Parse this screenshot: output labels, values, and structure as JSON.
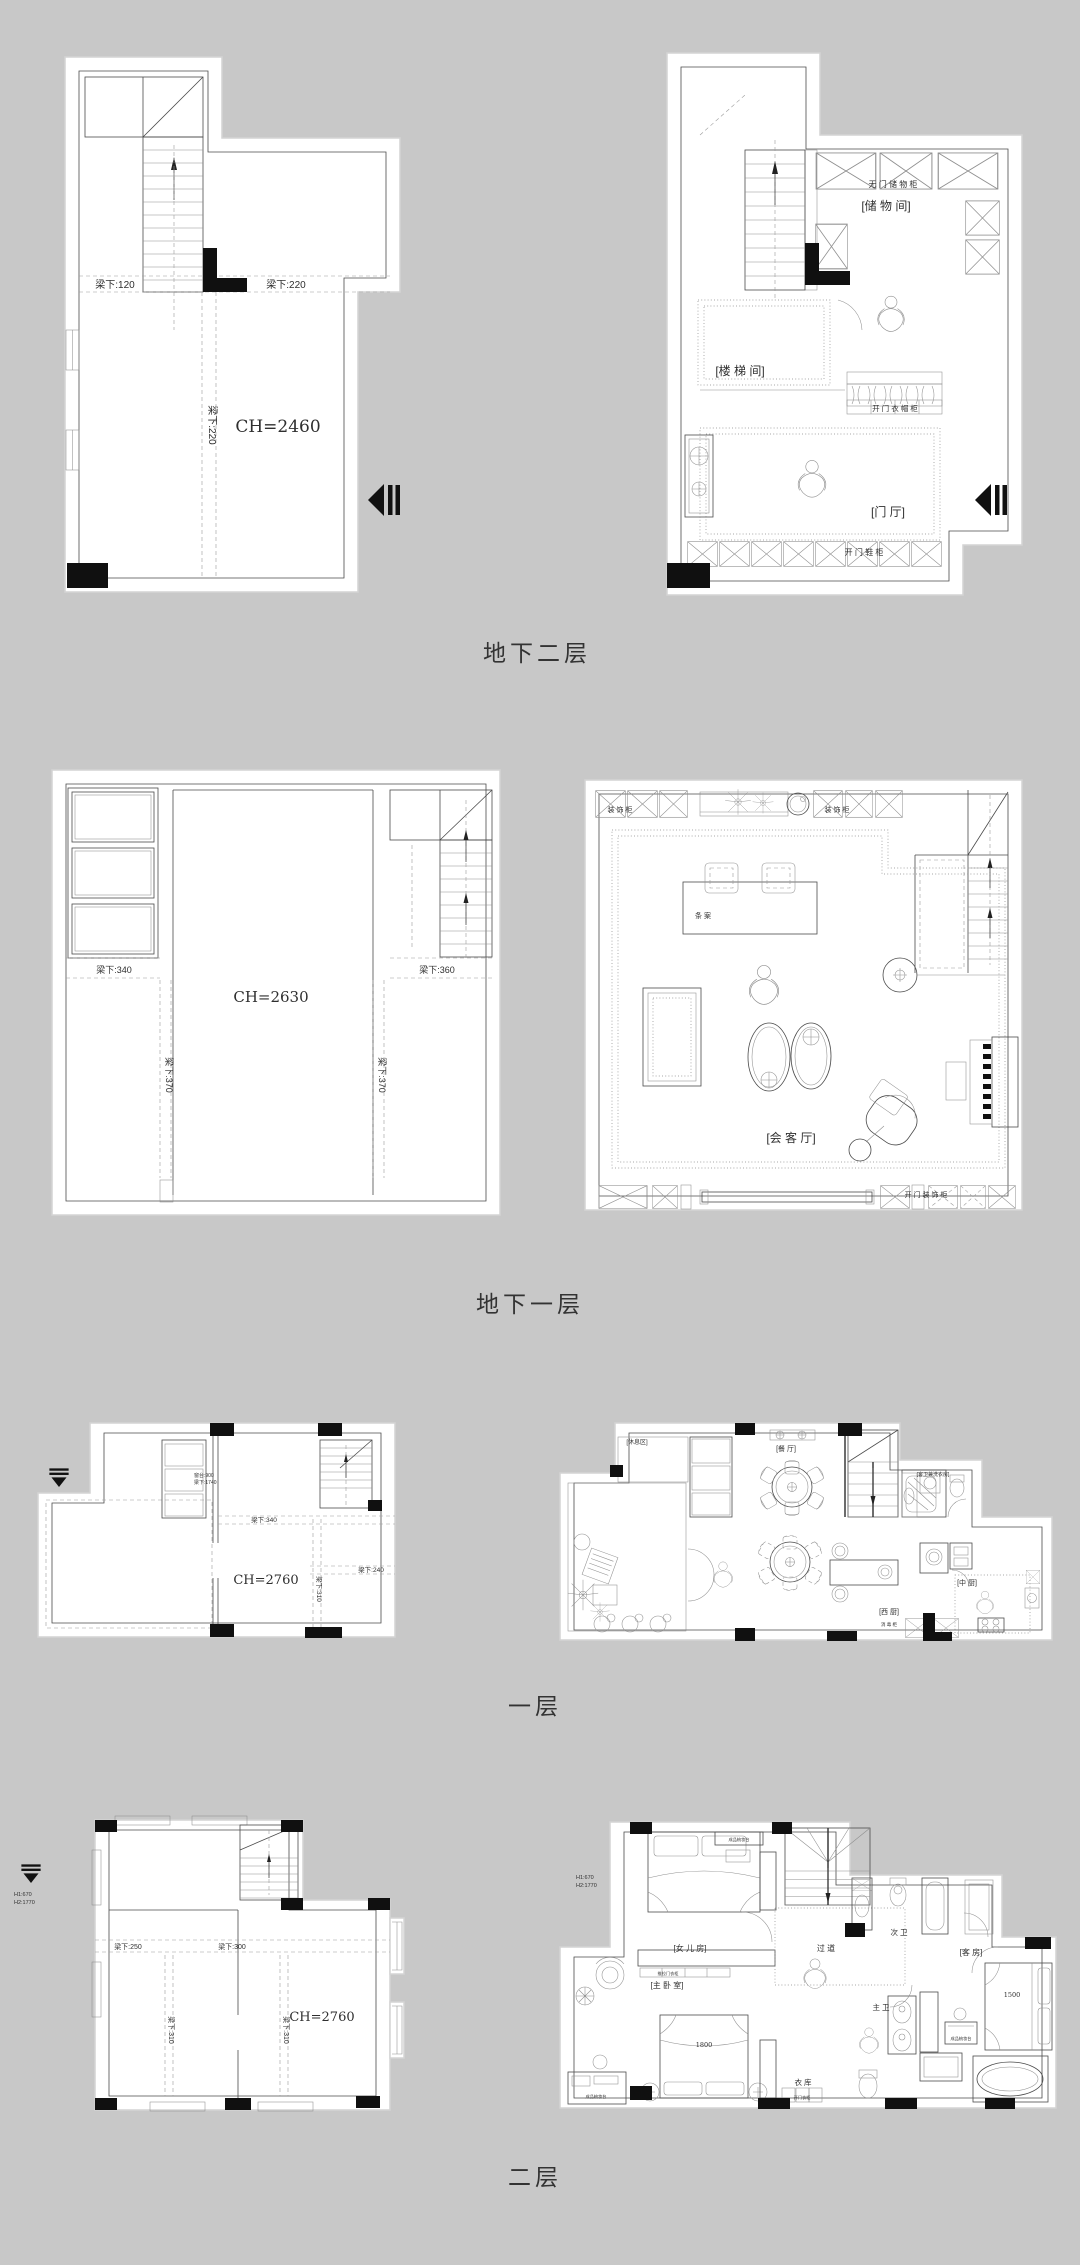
{
  "page": {
    "background": "#c8c8c8",
    "panel_color": "#ffffff",
    "line_color": "#4b4b4b",
    "column_fill": "#111111"
  },
  "levels": {
    "b2": {
      "title": "地下二层",
      "structural": {
        "beam_left": "梁下:120",
        "beam_right": "梁下:220",
        "beam_vertical": "梁下:220",
        "ceiling_height": "CH=2460"
      },
      "furnished": {
        "cabinet_top": "无 门 储 物 柜",
        "room_storage": "[储 物 间]",
        "room_stairwell": "[楼 梯 间]",
        "cabinet_wardrobe": "开 门 衣 帽 柜",
        "room_foyer": "[门   厅]",
        "cabinet_shoe": "开 门 鞋 柜"
      }
    },
    "b1": {
      "title": "地下一层",
      "structural": {
        "beam_left": "梁下:340",
        "beam_right": "梁下:360",
        "beam_vertical_1": "梁下:370",
        "beam_vertical_2": "梁下:370",
        "ceiling_height": "CH=2630"
      },
      "furnished": {
        "cabinet_deco_left": "装 饰 柜",
        "cabinet_deco_right": "装 饰 柜",
        "console_table": "条 案",
        "room_reception": "[会  客  厅]",
        "cabinet_deco_bottom": "开 门 装 饰 柜"
      }
    },
    "f1": {
      "title": "一层",
      "structural": {
        "window_sill": "窗台:900",
        "window_beam": "梁下:1740",
        "beam_mid": "梁下:340",
        "beam_right": "梁下:240",
        "beam_vertical": "梁下:310",
        "ceiling_height": "CH=2760"
      },
      "furnished": {
        "room_rest": "[休息区]",
        "room_dining": "[餐  厅]",
        "room_guest_bath": "[客卫兼洗衣房]",
        "room_west_kitchen": "[西  厨]",
        "room_chinese_kitchen": "[中  厨]",
        "cabinet_label": "消 毒 柜"
      }
    },
    "f2": {
      "title": "二层",
      "structural": {
        "beam_left": "梁下:250",
        "beam_right": "梁下:300",
        "beam_vertical_1": "梁下:310",
        "beam_vertical_2": "梁下:310",
        "ceiling_height": "CH=2760",
        "note_h1": "H1:670",
        "note_h2": "H2:1770"
      },
      "furnished": {
        "room_daughter": "[女 儿 房]",
        "room_master": "[主 卧 室]",
        "room_guest": "[客  房]",
        "corridor": "过  道",
        "bath_secondary": "次  卫",
        "bath_master": "主  卫",
        "closet_room": "衣  库",
        "bed_master_width": "1800",
        "bed_guest_width": "1500",
        "dresser_label_1": "成品梳妆台",
        "dresser_label_2": "成品梳妆台",
        "dresser_label_3": "成品梳妆台",
        "wardrobe_label": "推拉门衣柜",
        "closet_label": "开门衣柜",
        "note_h1": "H1:670",
        "note_h2": "H2:1770"
      }
    }
  }
}
